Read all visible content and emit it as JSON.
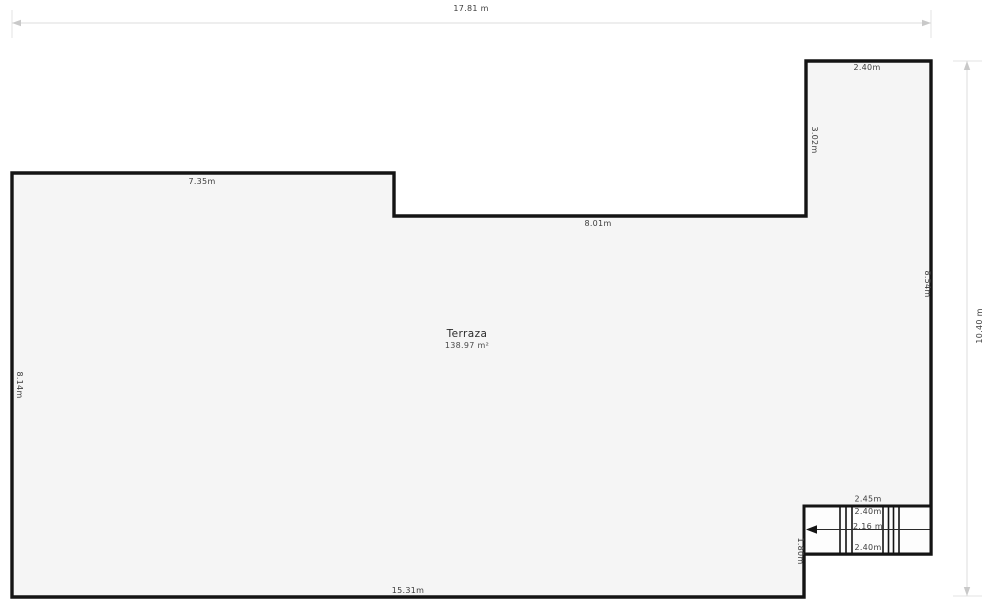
{
  "plan": {
    "room": {
      "name": "Terraza",
      "area": "138.97 m²"
    },
    "dimensions": {
      "top_total": "17.81 m",
      "right_total": "10.40 m",
      "top_left_edge": "7.35m",
      "middle_edge": "8.01m",
      "upper_right_width": "2.40m",
      "upper_right_height": "3.02m",
      "right_edge": "8.54m",
      "left_edge": "8.14m",
      "bottom_edge": "15.31m",
      "stair_width": "2.45m",
      "stair_run_top": "2.40m",
      "stair_arrow_length": "2.16 m",
      "stair_run_bottom": "2.40m",
      "stair_side_height": "1.80m"
    },
    "colors": {
      "room_fill": "#f5f5f5",
      "stair_fill": "#fdfdfd",
      "wall": "#141414",
      "dim_line": "#dedede",
      "label_text": "#3c3c3c"
    }
  }
}
